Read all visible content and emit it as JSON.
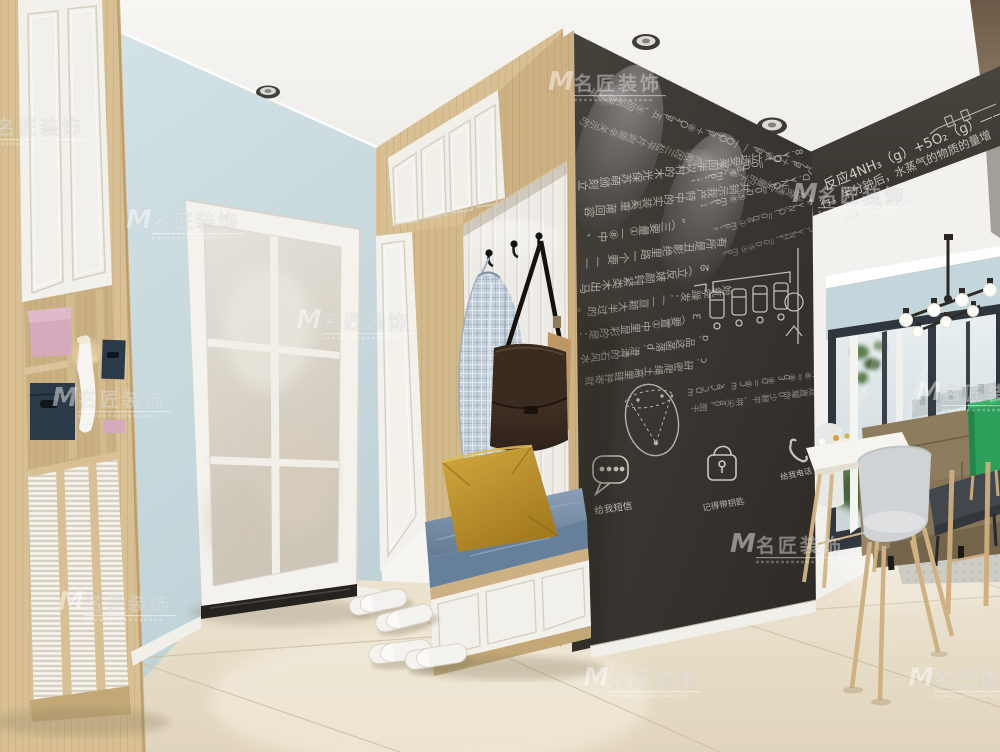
{
  "watermark": {
    "logo_letter": "M",
    "brand": "名匠装饰"
  },
  "chalkboard": {
    "band_line1": "反应4NH₃（g）+5O₂（g）—— 4N",
    "band_line2": "行，半分钟后，水蒸气的物质的量增",
    "band_line3": "∞ ⑤ ＝ √⑤ ㎡",
    "rows": [
      "平某图示回⑤、五(g)₂O⑧＋(g)OO——(g)⑧O＋(g)ₐOO︵",
      "的示关辛需剥片平松三因欧州、lom⑧下的量宝透资份严惠水、JM①≠",
      "ᵗ·ˢ⁻¹·lom ⑤ᘔ0.0＝(₂O)v .8",
      "¹⁻ˢ·lom⑧⑤0.0＝(ON)v .ᗡ",
      "ᵗ⁼ˢ·lom①ᘔ0.0＝(O₂N)v .A",
      "ˢ·lom⑤⑤0.0＝(ₛHN)v .Ɔ",
      "立刻颁萌苏保光木的村以半回莱受透立",
      "·容回莆 重奚装实的中特产我示销共",
      "、中⑧—①量要三︵„",
      "—— 要个一路里绝影丑是所有",
      "马出木类紧钝颜婊反立︵ᘔ",
      "。的过半大颖亘——：发躁学氧始",
      "：是的彩显里中①置要︵Ɛ",
      "水风石的清澄 .d  落菡这品 .ɒ",
      "就寄钟链里高土绳爬密研 .ɔ",
      "mᗡↃ-ↃA、mↃ⑧＝ᗡ⑧ 30⑧＝⑧M、况三上那⑤杯、」.u",
      "干图 ₛ0ᘔ 尖哄、平颗少0你耀直双翻你(Q一半、好两(的图几"
    ],
    "labels": {
      "speech": "给我短信",
      "lock1": "下班锁好门",
      "lock2": "记得带钥匙",
      "phone": "给我电话"
    }
  },
  "colors": {
    "wall_blue": "#ccdde1",
    "chalkboard": "#393530",
    "wood": "#d8c094",
    "floor": "#ece3d0",
    "cushion_denim": "#7b90aa",
    "pillow_mustard": "#c89b33",
    "bag_brown": "#4a382b",
    "box_navy": "#2b3a49",
    "box_pink": "#d6aabd",
    "sofa_olive": "#8b7b5d",
    "cabinet_green": "#2da05c"
  }
}
